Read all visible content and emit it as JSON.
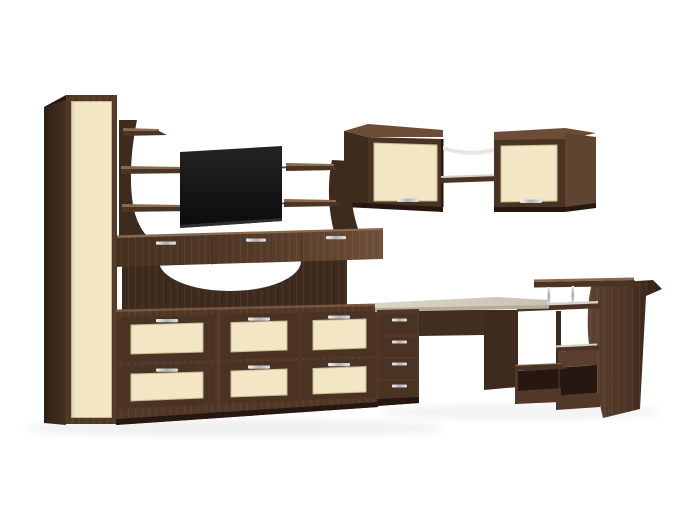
{
  "scene": {
    "type": "product-render",
    "description": "3D render of a modular living-room furniture set in dark brown wood with cream door and drawer panels on a white background",
    "objects": [
      {
        "name": "wardrobe",
        "label": "Tall single-door wardrobe with cream panel"
      },
      {
        "name": "tv-shelf-left-panel",
        "label": "Curved open-shelf panel left of TV"
      },
      {
        "name": "tv-screen",
        "label": "Flat black TV screen"
      },
      {
        "name": "tv-shelf-right-panel",
        "label": "Curved open-shelf panel right of TV"
      },
      {
        "name": "bridge-cabinet",
        "label": "Wall-to-wall TV stand cabinet with three drawers"
      },
      {
        "name": "arched-back-panel",
        "label": "Back panel with white arched cutout"
      },
      {
        "name": "drawer-chest",
        "label": "Chest with six cream-front drawers in three columns"
      },
      {
        "name": "wall-cabinet-set",
        "label": "Two corner wall cabinets with cream doors joined by open shelves"
      },
      {
        "name": "corner-desk",
        "label": "Corner computer desk with four-drawer pedestal"
      },
      {
        "name": "shelf-tower",
        "label": "Desk-end shelf tower with curved side and raised shelf on metal posts"
      }
    ]
  },
  "palette": {
    "background": "#ffffff",
    "wood_darkest": "#261811",
    "wood_dark": "#3e2b1e",
    "wood_mid": "#523827",
    "wood_frame": "#4a3323",
    "wood_lit": "#6d4d37",
    "wood_side_lit": "#5f4431",
    "wood_slab": "#4a3425",
    "wood_edge_light": "#8a6a4e",
    "wood_shadowed": "#422e1f",
    "slab_highlight": "#d8d1c4",
    "cream": "#f2e6c4",
    "cream_border": "#c9b78e",
    "desktop_top": "#d6cec0",
    "desktop_edge": "#b5ab9c",
    "glass_shelf": "#e9e6e0",
    "metal_rod": "#4b4b4b",
    "tv_screen": "#101010",
    "chrome": "#c9cccf",
    "floor_shadow": "rgba(0,0,0,0.06)"
  }
}
